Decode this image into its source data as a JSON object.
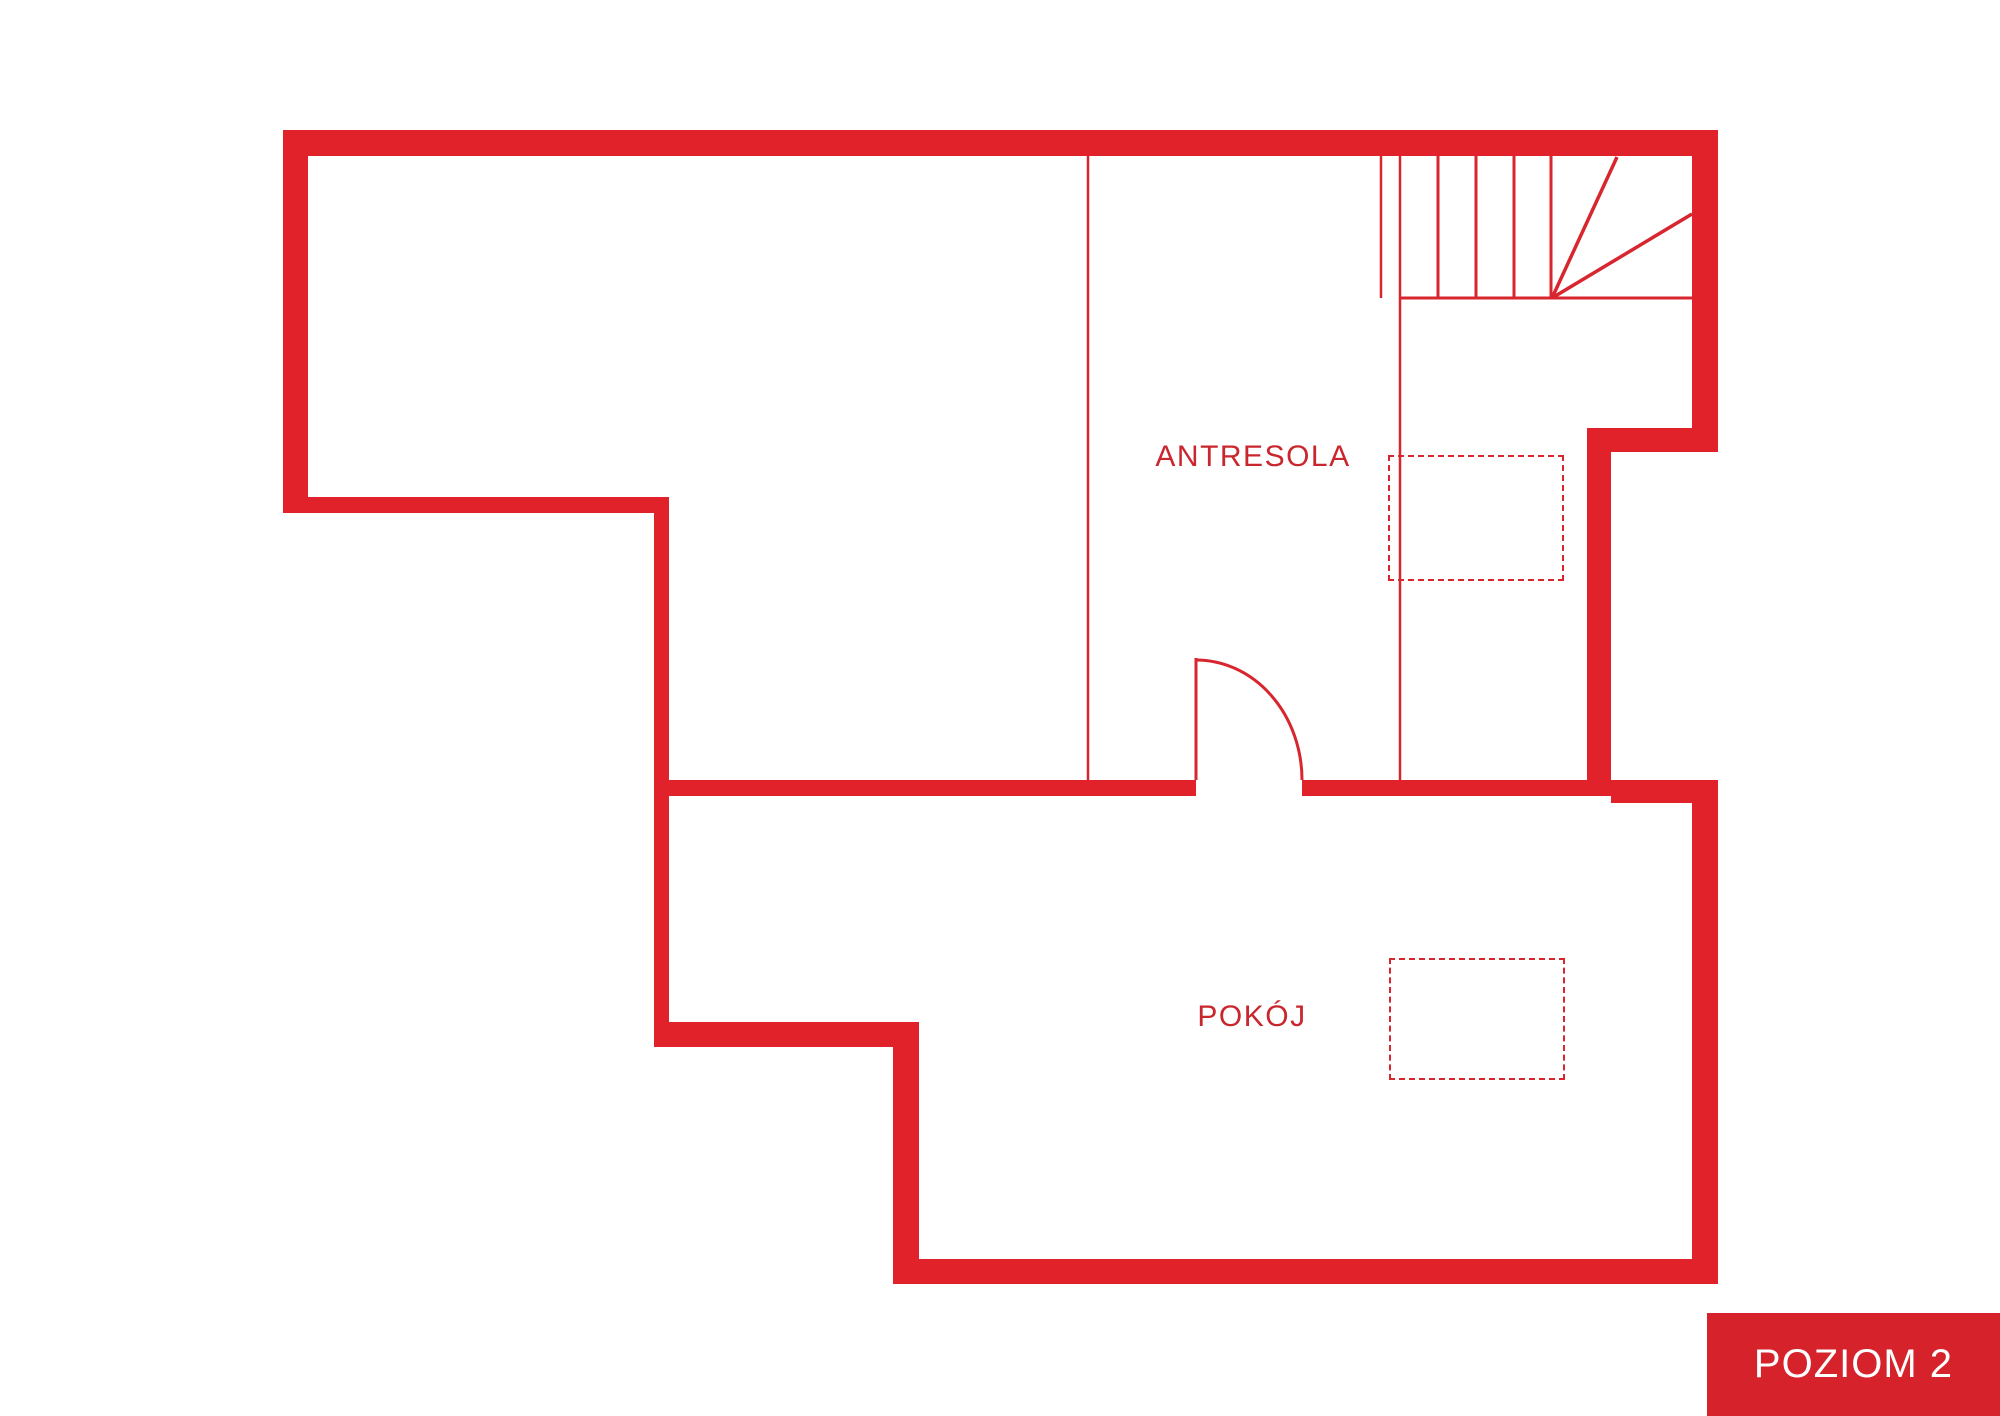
{
  "plan": {
    "rooms": [
      {
        "id": "antresola",
        "label": "ANTRESOLA"
      },
      {
        "id": "pokoj",
        "label": "POKÓJ"
      }
    ],
    "level_badge": "POZIOM 2"
  },
  "colors": {
    "wall": "#e2222b",
    "line": "#d8262e",
    "label": "#c9262e",
    "badge-bg": "#d6232b",
    "badge-text": "#ffffff",
    "bg": "#ffffff"
  }
}
